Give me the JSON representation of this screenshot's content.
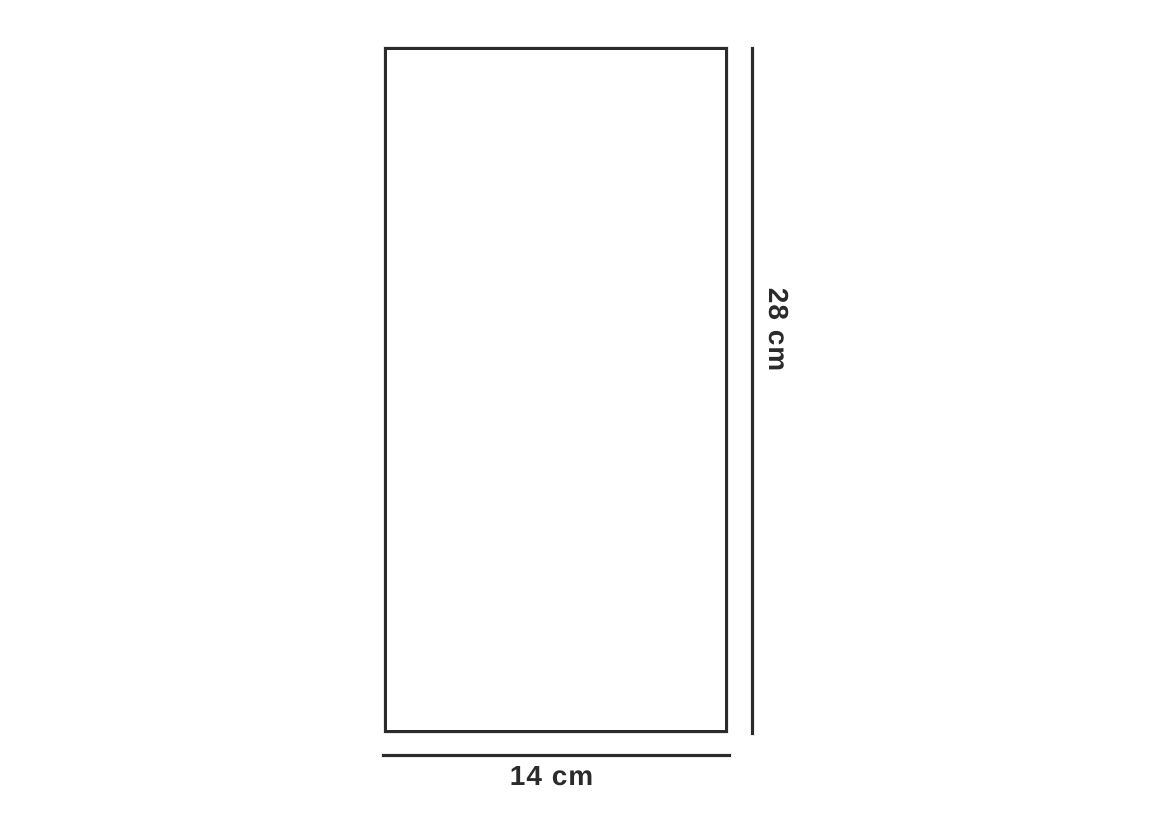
{
  "figure": {
    "shape": "rectangle",
    "height_label": "28 cm",
    "width_label": "14 cm",
    "height_value_cm": 28,
    "width_value_cm": 14
  },
  "colors": {
    "line": "#2b2b2b",
    "background": "#ffffff"
  }
}
